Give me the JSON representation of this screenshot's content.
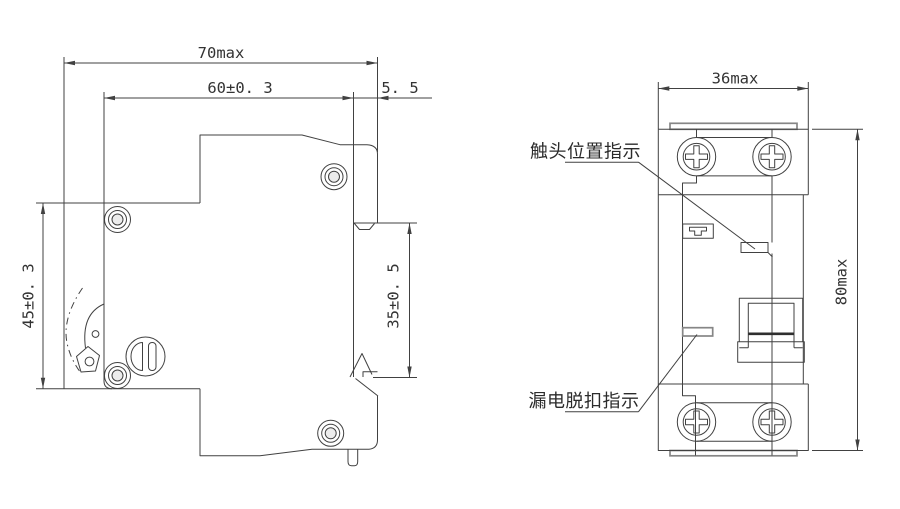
{
  "side_view": {
    "dim_total_depth": "70max",
    "dim_body_depth": "60±0. 3",
    "dim_rail_lip": "5. 5",
    "dim_front_height": "45±0. 3",
    "dim_rail_recess": "35±0. 5"
  },
  "front_view": {
    "dim_width": "36max",
    "dim_height": "80max",
    "label_contact_position_indicator": "触头位置指示",
    "label_leakage_trip_indicator": "漏电脱扣指示"
  },
  "colors": {
    "line": "#414141",
    "soft_line": "#868686",
    "background": "#ffffff"
  }
}
